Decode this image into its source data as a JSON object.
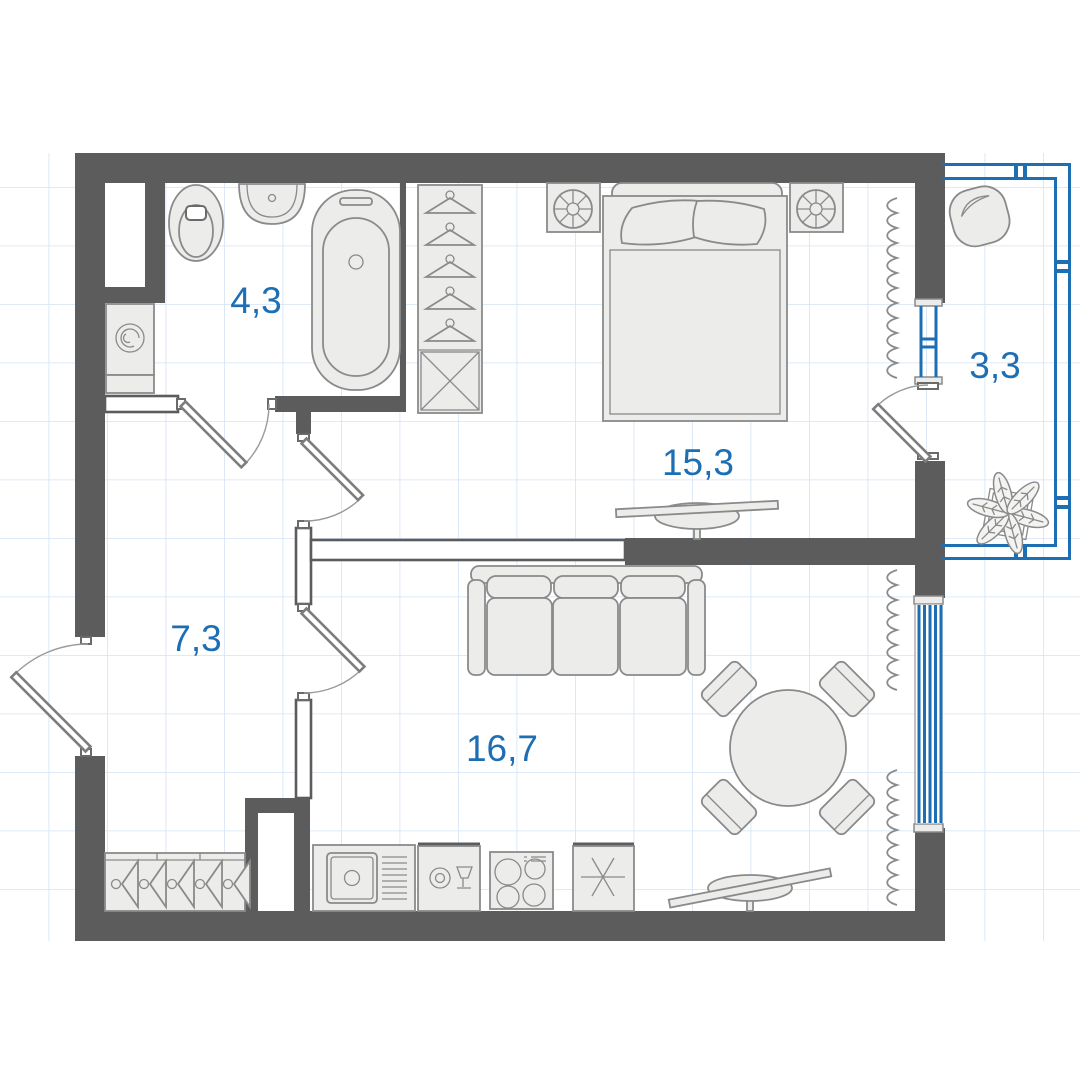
{
  "floor_plan": {
    "rooms": [
      {
        "id": "bathroom",
        "area_label": "4,3"
      },
      {
        "id": "bedroom",
        "area_label": "15,3"
      },
      {
        "id": "balcony",
        "area_label": "3,3"
      },
      {
        "id": "hallway",
        "area_label": "7,3"
      },
      {
        "id": "living_kitchen",
        "area_label": "16,7"
      }
    ],
    "colors": {
      "walls": "#5c5c5c",
      "accent_blue": "#1e6eb4",
      "grid": "#d3e3f4",
      "furniture_fill": "#ececea",
      "furniture_stroke": "#8a8a8a",
      "background": "#ffffff"
    },
    "symbols": [
      {
        "name": "toilet"
      },
      {
        "name": "sink"
      },
      {
        "name": "bathtub"
      },
      {
        "name": "washing-machine"
      },
      {
        "name": "wardrobe-with-hangers"
      },
      {
        "name": "double-bed"
      },
      {
        "name": "nightstand-table-lamp"
      },
      {
        "name": "radiator"
      },
      {
        "name": "tv-on-stand"
      },
      {
        "name": "sofa"
      },
      {
        "name": "round-dining-table"
      },
      {
        "name": "dining-chair"
      },
      {
        "name": "kitchen-sink"
      },
      {
        "name": "dishwasher"
      },
      {
        "name": "stove"
      },
      {
        "name": "fridge-snowflake"
      },
      {
        "name": "coat-rack"
      },
      {
        "name": "beanbag-chair"
      },
      {
        "name": "plant"
      },
      {
        "name": "window-glazing"
      },
      {
        "name": "door-swing"
      }
    ]
  }
}
